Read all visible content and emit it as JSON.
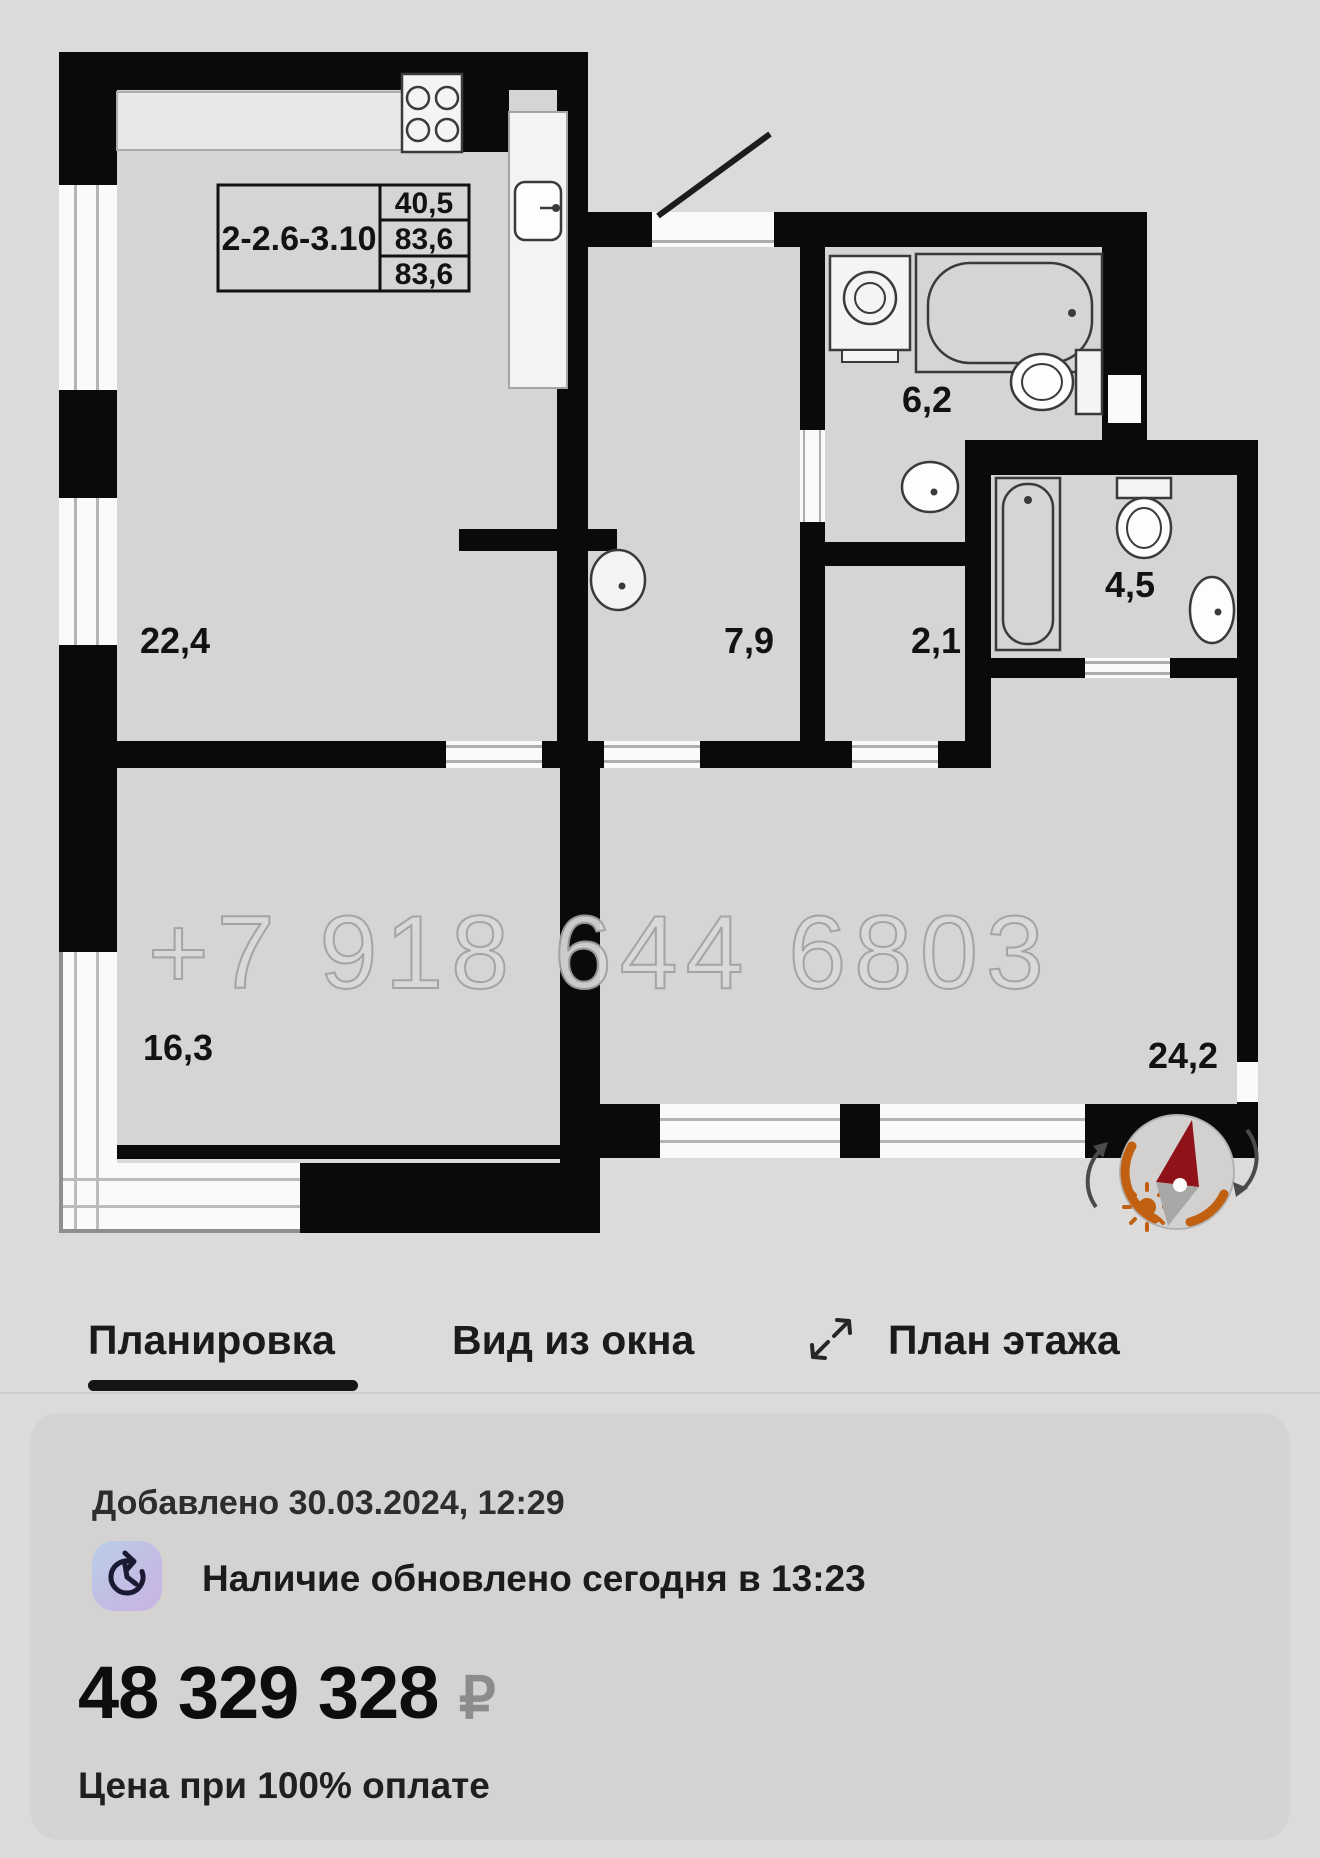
{
  "plan": {
    "unit_label": {
      "id": "2-2.6-3.10",
      "values": [
        "40,5",
        "83,6",
        "83,6"
      ]
    },
    "rooms": [
      {
        "name": "kitchen-living",
        "area": "22,4"
      },
      {
        "name": "hallway",
        "area": "7,9"
      },
      {
        "name": "bathroom",
        "area": "6,2"
      },
      {
        "name": "small-hall",
        "area": "2,1"
      },
      {
        "name": "bathroom-2",
        "area": "4,5"
      },
      {
        "name": "bedroom",
        "area": "16,3"
      },
      {
        "name": "bedroom-master",
        "area": "24,2"
      }
    ],
    "watermark": "+7 918 644 6803"
  },
  "tabs": {
    "items": [
      {
        "label": "Планировка",
        "active": true
      },
      {
        "label": "Вид из окна",
        "active": false
      },
      {
        "label": "План этажа",
        "active": false
      }
    ]
  },
  "card": {
    "added": "Добавлено 30.03.2024, 12:29",
    "availability": "Наличие обновлено сегодня в 13:23",
    "price": "48 329 328",
    "currency": "₽",
    "price_note": "Цена при 100% оплате"
  },
  "colors": {
    "page_bg": "#dcdbda",
    "card_bg": "#d4d3d2",
    "room_fill": "#d6d5d4",
    "wall": "#0a0a0a",
    "accent_orange": "#c06010",
    "needle_red": "#8f1218",
    "price_currency_gray": "#8c8c8c"
  }
}
